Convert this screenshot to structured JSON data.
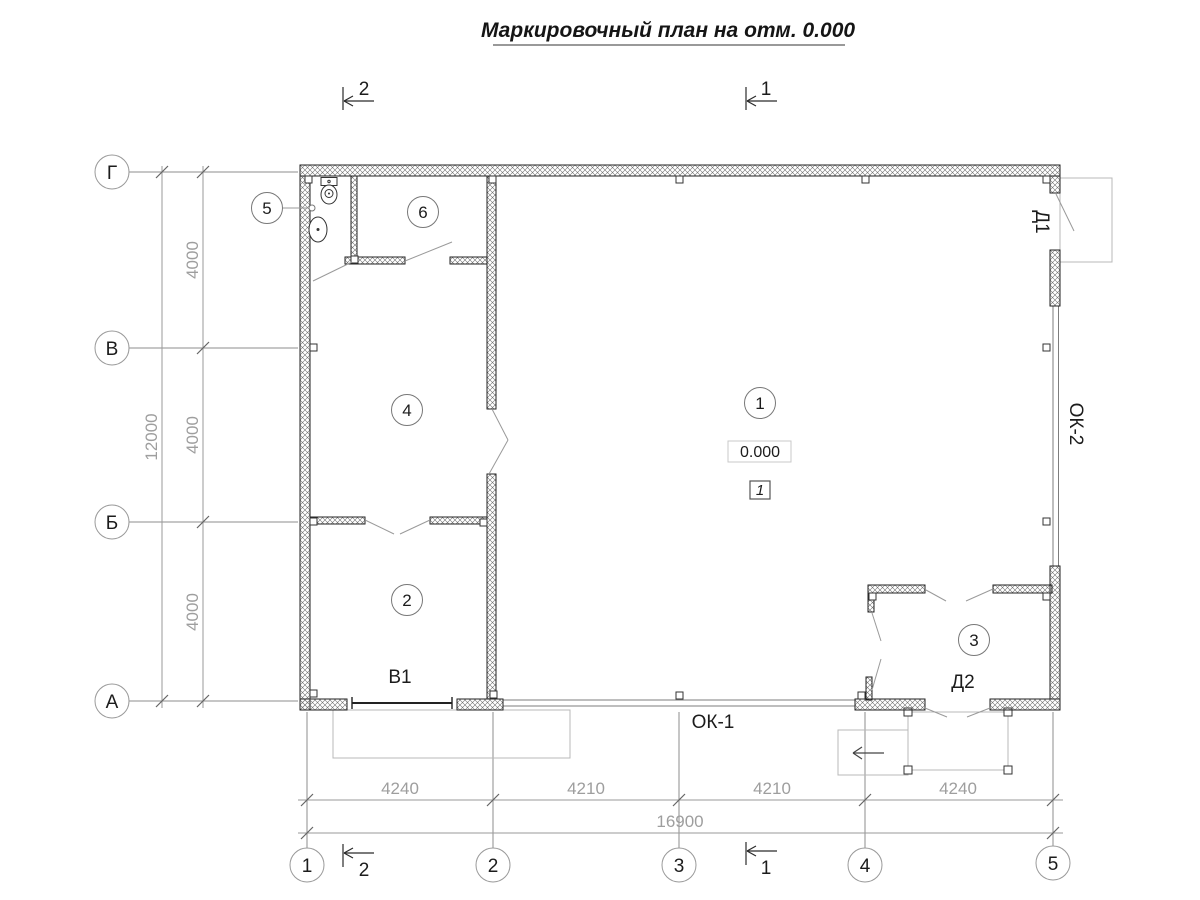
{
  "title": "Маркировочный план на отм. 0.000",
  "axes": {
    "rows": [
      {
        "label": "Г"
      },
      {
        "label": "В"
      },
      {
        "label": "Б"
      },
      {
        "label": "А"
      }
    ],
    "cols": [
      {
        "label": "1"
      },
      {
        "label": "2"
      },
      {
        "label": "3"
      },
      {
        "label": "4"
      },
      {
        "label": "5"
      }
    ]
  },
  "dimensions": {
    "bottom_segments": [
      "4240",
      "4210",
      "4210",
      "4240"
    ],
    "bottom_total": "16900",
    "left_segments": [
      "4000",
      "4000",
      "4000"
    ],
    "left_total": "12000"
  },
  "rooms": [
    {
      "number": "1"
    },
    {
      "number": "2"
    },
    {
      "number": "3"
    },
    {
      "number": "4"
    },
    {
      "number": "5"
    },
    {
      "number": "6"
    }
  ],
  "marks": {
    "door_1": "Д1",
    "door_2": "Д2",
    "window_1": "ОК-1",
    "window_2": "ОК-2",
    "gate": "В1",
    "elevation": "0.000",
    "plan_note": "1"
  },
  "sections": {
    "top": [
      {
        "label": "2"
      },
      {
        "label": "1"
      }
    ],
    "bottom": [
      {
        "label": "2"
      },
      {
        "label": "1"
      }
    ]
  },
  "colors": {
    "line": "#1f1f1f",
    "dim_text": "#9e9e9e",
    "axis_line": "#8d8d8d",
    "construction": "#b8b8b8"
  }
}
